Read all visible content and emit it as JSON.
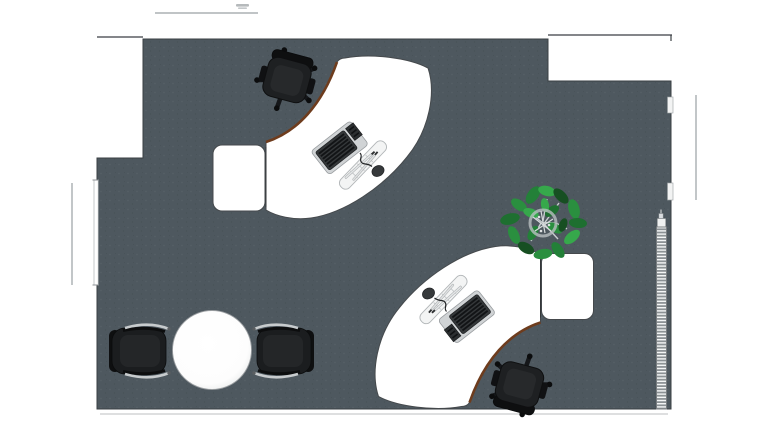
{
  "scene": {
    "type": "office-floor-plan-top-view",
    "room": {
      "walls": "thin dark outline",
      "floor_material": "dark speckled carpet"
    }
  },
  "palette": {
    "floor": "#4e585f",
    "floor_speckle_light": "#5c666d",
    "floor_speckle_dark": "#424b51",
    "wall": "#3a3f43",
    "wall_light": "#c9cccd",
    "exterior_line": "#9aa0a3",
    "desk": "#ffffff",
    "desk_edge": "#45494c",
    "desk_trim": "#6e3c1d",
    "chair_body": "#1e2022",
    "chair_dark": "#0e0f10",
    "chair_cushion": "#27292b",
    "chair_leg": "#15171a",
    "guest_seat": "#1b1d1f",
    "armrest": "#c7cbcd",
    "table_fill": "#ffffff",
    "table_rim": "#999da0",
    "radiator_frame": "#787d80",
    "radiator_fin_light": "#f4f6f6",
    "radiator_fin_dark": "#8b9194",
    "tray": "#d0d3d5",
    "keyboard": "#35383a",
    "key_row": "#121416",
    "mouse": "#36393b",
    "pen_bar": "#f3f4f4",
    "pen": "#e4e6e7",
    "plant_deep": "#174f22",
    "plant_dark": "#1e6f30",
    "plant_mid": "#2a8f3f",
    "plant_bright": "#36a84b",
    "plant_shade": "#238038",
    "twig": "#c9ced0"
  },
  "annotations": {
    "top_dimension": {
      "description": "illegible tiny dimension label above exterior line"
    }
  },
  "objects": [
    {
      "name": "room-floor"
    },
    {
      "name": "doorway-opening-left"
    },
    {
      "name": "wall-recess-top-right"
    },
    {
      "name": "window-left"
    },
    {
      "name": "door-jambs-right"
    },
    {
      "name": "radiator"
    },
    {
      "name": "workstation-top",
      "parts": [
        "curved-desk",
        "desk-return",
        "office-chair",
        "keyboard",
        "numpad",
        "pen-tray",
        "pens",
        "mouse"
      ]
    },
    {
      "name": "workstation-bottom",
      "parts": [
        "curved-desk",
        "desk-return",
        "office-chair",
        "keyboard",
        "numpad",
        "pen-tray",
        "pens",
        "mouse"
      ]
    },
    {
      "name": "potted-plant"
    },
    {
      "name": "round-meeting-table"
    },
    {
      "name": "guest-chair-left"
    },
    {
      "name": "guest-chair-right"
    }
  ]
}
